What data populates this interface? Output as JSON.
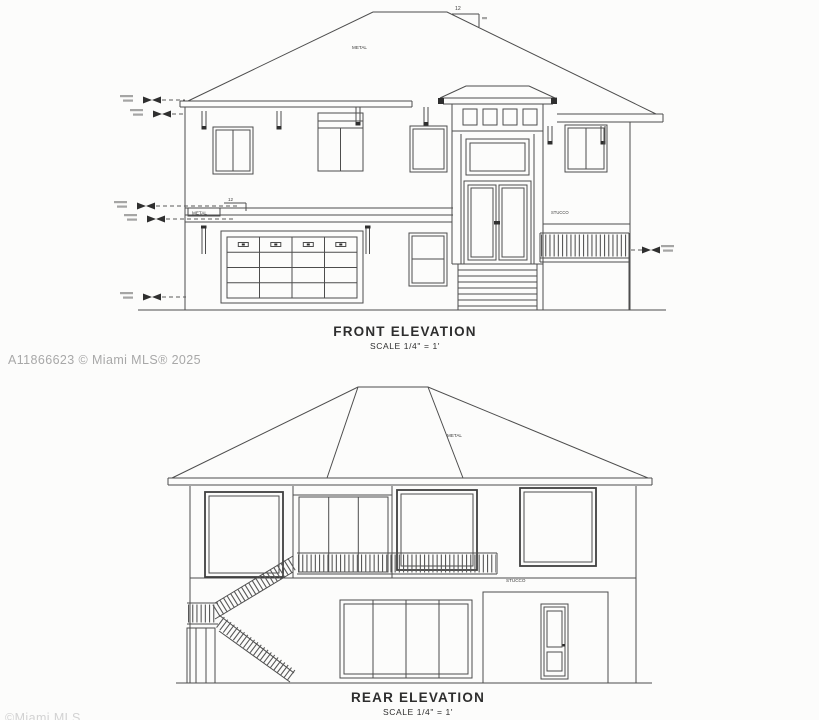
{
  "canvas": {
    "background": "#fcfcfb",
    "line_color": "#4d4d4d"
  },
  "watermarks": {
    "mls_id": "A11866623 © Miami MLS® 2025",
    "bottom_partial": "©Miami MLS"
  },
  "front": {
    "title": "FRONT ELEVATION",
    "scale_note": "SCALE 1/4\" = 1'",
    "roof_material_label": "METAL",
    "roof_slope_rise": "12",
    "band_material_label": "METAL",
    "band_slope_rise": "12",
    "wall_material_label": "STUCCO"
  },
  "rear": {
    "title": "REAR ELEVATION",
    "scale_note": "SCALE 1/4\" = 1'",
    "roof_material_label": "METAL",
    "wall_material_label": "STUCCO"
  }
}
